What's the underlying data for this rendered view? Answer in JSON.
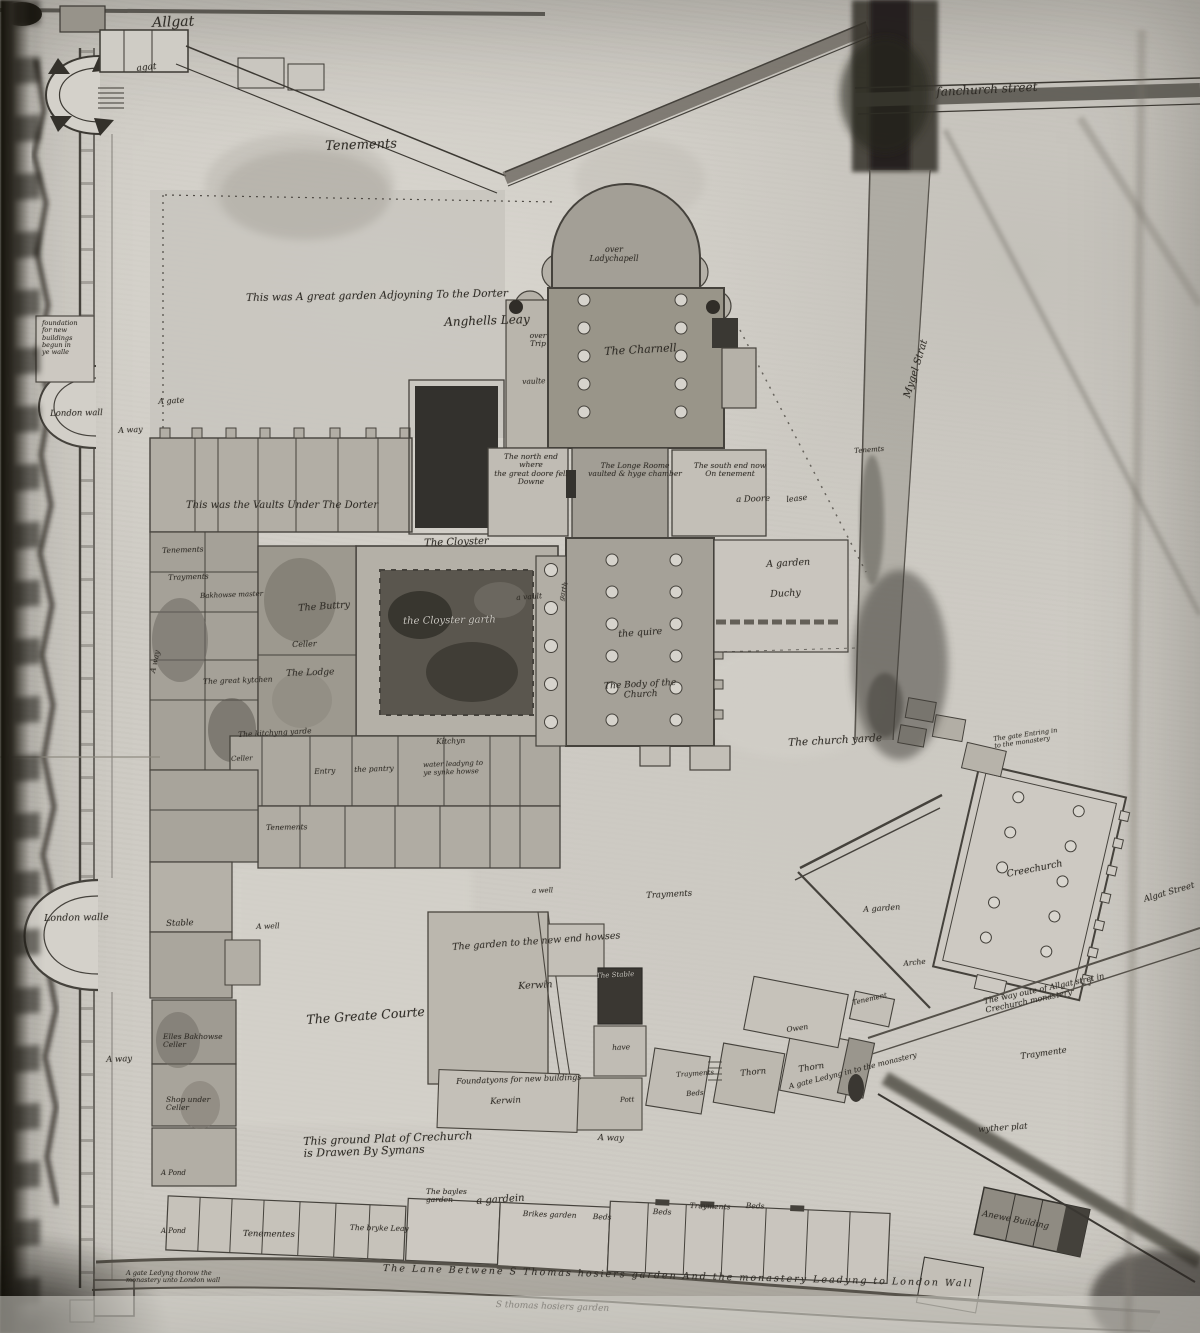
{
  "meta": {
    "document_title": "This ground Plat of Crechurch is Drawen By Symans",
    "description_visible_on_map": "Ground plan of Crechurch (Holy Trinity Priory) drawn by Symans"
  },
  "map": {
    "labels": [
      {
        "name": "label-allgat",
        "text": "Allgat",
        "x": 152,
        "y": 16,
        "size": 14,
        "rot": -2
      },
      {
        "name": "label-agat",
        "text": "agat",
        "x": 136,
        "y": 64,
        "size": 9,
        "rot": -6
      },
      {
        "name": "label-tenements-top",
        "text": "Tenements",
        "x": 325,
        "y": 140,
        "size": 13,
        "rot": -2
      },
      {
        "name": "label-fanchurch-street",
        "text": "fanchurch street",
        "x": 936,
        "y": 86,
        "size": 12,
        "rot": -3
      },
      {
        "name": "label-great-garden",
        "text": "This was A great garden Adjoyning To the Dorter",
        "x": 246,
        "y": 293,
        "size": 10.5,
        "rot": -1
      },
      {
        "name": "label-anghells-leay",
        "text": "Anghells Leay",
        "x": 444,
        "y": 316,
        "size": 12,
        "rot": -2
      },
      {
        "name": "label-foundation-note",
        "text": "foundation\nfor new\nbuildings\nbegun in\nye walle",
        "x": 42,
        "y": 320,
        "size": 6.5,
        "w": 50
      },
      {
        "name": "label-a-gate-left",
        "text": "A gate",
        "x": 158,
        "y": 398,
        "size": 8,
        "rot": -3
      },
      {
        "name": "label-a-way-1",
        "text": "A way",
        "x": 118,
        "y": 427,
        "size": 8,
        "rot": -3
      },
      {
        "name": "label-over-ladychapell",
        "text": "over\nLadychapell",
        "x": 583,
        "y": 246,
        "size": 8,
        "w": 62,
        "center": true
      },
      {
        "name": "label-the-charnell",
        "text": "The Charnell",
        "x": 604,
        "y": 346,
        "size": 11,
        "rot": -3
      },
      {
        "name": "label-over-trip",
        "text": "over\nTrip",
        "x": 523,
        "y": 332,
        "size": 7.5,
        "w": 30,
        "center": true
      },
      {
        "name": "label-vaulte",
        "text": "vaulte",
        "x": 522,
        "y": 378,
        "size": 7.5,
        "rot": -2
      },
      {
        "name": "label-north-end",
        "text": "The north end where\nthe great doore fell\nDowne",
        "x": 494,
        "y": 453,
        "size": 7.5,
        "w": 74,
        "center": true
      },
      {
        "name": "label-longe-roome",
        "text": "The Longe Roome\nvaulted & hyge chamber",
        "x": 586,
        "y": 462,
        "size": 7.5,
        "w": 98,
        "center": true
      },
      {
        "name": "label-south-end",
        "text": "The south end now\nOn tenement",
        "x": 686,
        "y": 462,
        "size": 7.5,
        "w": 88,
        "center": true
      },
      {
        "name": "label-a-doore",
        "text": "a Doore",
        "x": 736,
        "y": 496,
        "size": 8.5,
        "rot": -2
      },
      {
        "name": "label-lease",
        "text": "lease",
        "x": 786,
        "y": 496,
        "size": 8,
        "rot": -6
      },
      {
        "name": "label-tenemts-right",
        "text": "Tenemts",
        "x": 854,
        "y": 448,
        "size": 7,
        "rot": -4
      },
      {
        "name": "label-mygel-strat",
        "text": "Mygel Strat",
        "x": 902,
        "y": 396,
        "size": 10,
        "rot": -73
      },
      {
        "name": "label-vaults-under-dorter",
        "text": "This was the    Vaults    Under    The    Dorter",
        "x": 186,
        "y": 500,
        "size": 10,
        "rot": 0
      },
      {
        "name": "label-the-cloyster",
        "text": "The Cloyster",
        "x": 424,
        "y": 538,
        "size": 10,
        "rot": -2
      },
      {
        "name": "label-tenements-left-1",
        "text": "Tenements",
        "x": 162,
        "y": 547,
        "size": 7.5,
        "rot": -2
      },
      {
        "name": "label-trayments-left",
        "text": "Trayments",
        "x": 168,
        "y": 574,
        "size": 7.5,
        "rot": -2
      },
      {
        "name": "label-bakhowse-master",
        "text": "Bakhowse master",
        "x": 200,
        "y": 593,
        "size": 7,
        "rot": -2
      },
      {
        "name": "label-the-buttry",
        "text": "The Buttry",
        "x": 298,
        "y": 604,
        "size": 9.5,
        "rot": -4
      },
      {
        "name": "label-celler-1",
        "text": "Celler",
        "x": 292,
        "y": 641,
        "size": 8,
        "rot": -2
      },
      {
        "name": "label-the-lodge",
        "text": "The Lodge",
        "x": 286,
        "y": 669,
        "size": 9,
        "rot": -2
      },
      {
        "name": "label-cloyster-garth",
        "text": "the Cloyster garth",
        "x": 403,
        "y": 616,
        "size": 10,
        "rot": -1,
        "light": true
      },
      {
        "name": "label-a-vault",
        "text": "a vault",
        "x": 516,
        "y": 594,
        "size": 7.5,
        "rot": -4
      },
      {
        "name": "label-garth-side",
        "text": "garth",
        "x": 558,
        "y": 600,
        "size": 7,
        "rot": -75
      },
      {
        "name": "label-the-quire",
        "text": "the quire",
        "x": 618,
        "y": 630,
        "size": 9.5,
        "rot": -4
      },
      {
        "name": "label-body-of-church",
        "text": "The Body of the\nChurch",
        "x": 598,
        "y": 682,
        "size": 9,
        "w": 84,
        "center": true,
        "rot": -3
      },
      {
        "name": "label-a-garden-duchy",
        "text": "A garden",
        "x": 766,
        "y": 560,
        "size": 9.5,
        "rot": -3
      },
      {
        "name": "label-duchy",
        "text": "Duchy",
        "x": 770,
        "y": 590,
        "size": 9.5,
        "rot": -3
      },
      {
        "name": "label-church-yarde",
        "text": "The church yarde",
        "x": 788,
        "y": 738,
        "size": 10.5,
        "rot": -3
      },
      {
        "name": "label-gate-entring",
        "text": "The gate Entring in\nto the monastery",
        "x": 993,
        "y": 736,
        "size": 6.5,
        "w": 72,
        "rot": -8
      },
      {
        "name": "label-creechurch",
        "text": "Creechurch",
        "x": 1006,
        "y": 870,
        "size": 9.5,
        "rot": -11
      },
      {
        "name": "label-algat-street",
        "text": "Algat Street",
        "x": 1143,
        "y": 896,
        "size": 8.5,
        "rot": -16
      },
      {
        "name": "label-a-garden-2",
        "text": "A garden",
        "x": 863,
        "y": 906,
        "size": 8,
        "rot": -4
      },
      {
        "name": "label-arche",
        "text": "Arche",
        "x": 903,
        "y": 960,
        "size": 7.5,
        "rot": -6
      },
      {
        "name": "label-tenement-diag",
        "text": "Tenement",
        "x": 852,
        "y": 1000,
        "size": 7,
        "rot": -13
      },
      {
        "name": "label-owen",
        "text": "Owen",
        "x": 786,
        "y": 1026,
        "size": 7.5,
        "rot": -8
      },
      {
        "name": "label-thorn-1",
        "text": "Thorn",
        "x": 740,
        "y": 1070,
        "size": 8.5,
        "rot": -6
      },
      {
        "name": "label-thorn-2",
        "text": "Thorn",
        "x": 798,
        "y": 1066,
        "size": 8.5,
        "rot": -9
      },
      {
        "name": "label-trayments-diag",
        "text": "Trayments",
        "x": 676,
        "y": 1072,
        "size": 7,
        "rot": -4
      },
      {
        "name": "label-beds-diag",
        "text": "Beds",
        "x": 686,
        "y": 1091,
        "size": 7,
        "rot": -4
      },
      {
        "name": "label-have",
        "text": "have",
        "x": 612,
        "y": 1044,
        "size": 7.5,
        "rot": -2
      },
      {
        "name": "label-pott",
        "text": "Pott",
        "x": 620,
        "y": 1097,
        "size": 7,
        "rot": -2
      },
      {
        "name": "label-the-stable",
        "text": "The Stable",
        "x": 596,
        "y": 973,
        "size": 7,
        "rot": -3,
        "light": true
      },
      {
        "name": "label-trayments-mid",
        "text": "Trayments",
        "x": 646,
        "y": 892,
        "size": 8.5,
        "rot": -3
      },
      {
        "name": "label-a-well-2",
        "text": "a well",
        "x": 532,
        "y": 888,
        "size": 7,
        "rot": -2
      },
      {
        "name": "label-garden-new-houses",
        "text": "The garden to  the  new end howses",
        "x": 452,
        "y": 943,
        "size": 9.5,
        "rot": -4
      },
      {
        "name": "label-kerwin-1",
        "text": "Kerwin",
        "x": 518,
        "y": 982,
        "size": 9.5,
        "rot": -3
      },
      {
        "name": "label-foundations-new",
        "text": "Foundatyons for new buildings",
        "x": 456,
        "y": 1078,
        "size": 8,
        "rot": -2
      },
      {
        "name": "label-kerwin-2",
        "text": "Kerwin",
        "x": 490,
        "y": 1098,
        "size": 8.5,
        "rot": -3
      },
      {
        "name": "label-greate-courte",
        "text": "The Greate Courte",
        "x": 306,
        "y": 1013,
        "size": 12.5,
        "rot": -4
      },
      {
        "name": "label-a-well-1",
        "text": "A well",
        "x": 256,
        "y": 923,
        "size": 7.5,
        "rot": -2
      },
      {
        "name": "label-stable-west",
        "text": "Stable",
        "x": 166,
        "y": 920,
        "size": 8.5,
        "rot": -2
      },
      {
        "name": "label-a-way-2",
        "text": "A way",
        "x": 106,
        "y": 1056,
        "size": 8.5,
        "rot": -2
      },
      {
        "name": "label-elles-bakhowse",
        "text": "Elles Bakhowse\nCeller",
        "x": 163,
        "y": 1033,
        "size": 7.5,
        "w": 72
      },
      {
        "name": "label-shop-under",
        "text": "Shop under\nCeller",
        "x": 166,
        "y": 1096,
        "size": 7.5,
        "w": 72
      },
      {
        "name": "label-pond-1",
        "text": "A Pond",
        "x": 161,
        "y": 1170,
        "size": 7
      },
      {
        "name": "label-pond-2",
        "text": "A Pond",
        "x": 161,
        "y": 1228,
        "size": 7
      },
      {
        "name": "label-tenementes-row",
        "text": "Tenementes",
        "x": 243,
        "y": 1230,
        "size": 8.5,
        "rot": 1
      },
      {
        "name": "label-bryke-leay",
        "text": "The bryke Leay",
        "x": 350,
        "y": 1224,
        "size": 7.5,
        "rot": 1
      },
      {
        "name": "label-bayles-garden",
        "text": "The bayles\ngarden",
        "x": 426,
        "y": 1188,
        "size": 7.5,
        "w": 56
      },
      {
        "name": "label-a-gardein",
        "text": "a gardein",
        "x": 476,
        "y": 1196,
        "size": 10,
        "rot": -4
      },
      {
        "name": "label-brikes-garden",
        "text": "Brikes garden",
        "x": 523,
        "y": 1210,
        "size": 7.5,
        "rot": 2
      },
      {
        "name": "label-beds-1",
        "text": "Beds",
        "x": 593,
        "y": 1213,
        "size": 7.5,
        "rot": 2
      },
      {
        "name": "label-beds-2",
        "text": "Beds",
        "x": 653,
        "y": 1208,
        "size": 7.5,
        "rot": 2
      },
      {
        "name": "label-trayments-row",
        "text": "Trayments",
        "x": 690,
        "y": 1202,
        "size": 7.5,
        "rot": 2
      },
      {
        "name": "label-beds-3",
        "text": "Beds",
        "x": 746,
        "y": 1202,
        "size": 7.5,
        "rot": 2
      },
      {
        "name": "label-lane-text",
        "text": "The Lane Betwene S Thomas hosiers garden And the monastery Leadyng to London Wall",
        "x": 383,
        "y": 1264,
        "size": 9.5,
        "rot": 1.5,
        "ls": 2
      },
      {
        "name": "label-thomas-garden",
        "text": "S thomas hosiers garden",
        "x": 496,
        "y": 1300,
        "size": 9,
        "rot": 2
      },
      {
        "name": "label-gate-ledyng-left",
        "text": "A gate Ledyng thorow the\nmonastery unto London wall",
        "x": 126,
        "y": 1270,
        "size": 6.5,
        "w": 98
      },
      {
        "name": "label-gate-ledyng-monastery",
        "text": "A gate Ledyng in to the monastery",
        "x": 788,
        "y": 1083,
        "size": 7.5,
        "rot": -14
      },
      {
        "name": "label-way-oute",
        "text": "The way oute of Allgat stret in\nCrechurch monastery",
        "x": 983,
        "y": 998,
        "size": 8,
        "w": 134,
        "rot": -12
      },
      {
        "name": "label-traymente-right",
        "text": "Traymente",
        "x": 1020,
        "y": 1053,
        "size": 8.5,
        "rot": -8
      },
      {
        "name": "label-wyther-plat",
        "text": "wyther plat",
        "x": 978,
        "y": 1126,
        "size": 8.5,
        "rot": -4
      },
      {
        "name": "label-anewe-building",
        "text": "Anewe Building",
        "x": 983,
        "y": 1210,
        "size": 8.5,
        "rot": 11
      },
      {
        "name": "label-ground-plat-title",
        "text": "This ground Plat of Crechurch\nis Drawen     By Symans",
        "x": 303,
        "y": 1136,
        "size": 11,
        "rot": -2
      },
      {
        "name": "label-london-wall-1",
        "text": "London wall",
        "x": 50,
        "y": 410,
        "size": 8.5,
        "rot": -1
      },
      {
        "name": "label-london-walle-2",
        "text": "London walle",
        "x": 44,
        "y": 914,
        "size": 9.5,
        "rot": -1
      },
      {
        "name": "label-kitchyng-yarde",
        "text": "The kitchyng yarde",
        "x": 238,
        "y": 731,
        "size": 7.5,
        "rot": -3
      },
      {
        "name": "label-celler-2",
        "text": "Celler",
        "x": 231,
        "y": 756,
        "size": 7,
        "rot": -2
      },
      {
        "name": "label-entry",
        "text": "Entry",
        "x": 314,
        "y": 768,
        "size": 7.5,
        "rot": -3
      },
      {
        "name": "label-the-pantry",
        "text": "the pantry",
        "x": 354,
        "y": 766,
        "size": 7.5,
        "rot": -2
      },
      {
        "name": "label-kitchyn",
        "text": "Kitchyn",
        "x": 436,
        "y": 738,
        "size": 7.5,
        "rot": -2
      },
      {
        "name": "label-water-synke",
        "text": "water leadyng to\nye synke howse",
        "x": 423,
        "y": 762,
        "size": 7,
        "w": 72,
        "rot": -2
      },
      {
        "name": "label-tenements-row2",
        "text": "Tenements",
        "x": 266,
        "y": 824,
        "size": 7.5,
        "rot": -1
      },
      {
        "name": "label-great-kytchen",
        "text": "The great kytchen",
        "x": 203,
        "y": 678,
        "size": 7.5,
        "rot": -2
      },
      {
        "name": "label-a-way-rot",
        "text": "A way",
        "x": 149,
        "y": 672,
        "size": 7.5,
        "rot": -78
      },
      {
        "name": "label-a-way-road",
        "text": "A way",
        "x": 598,
        "y": 1134,
        "size": 8.5,
        "rot": 2
      }
    ]
  }
}
